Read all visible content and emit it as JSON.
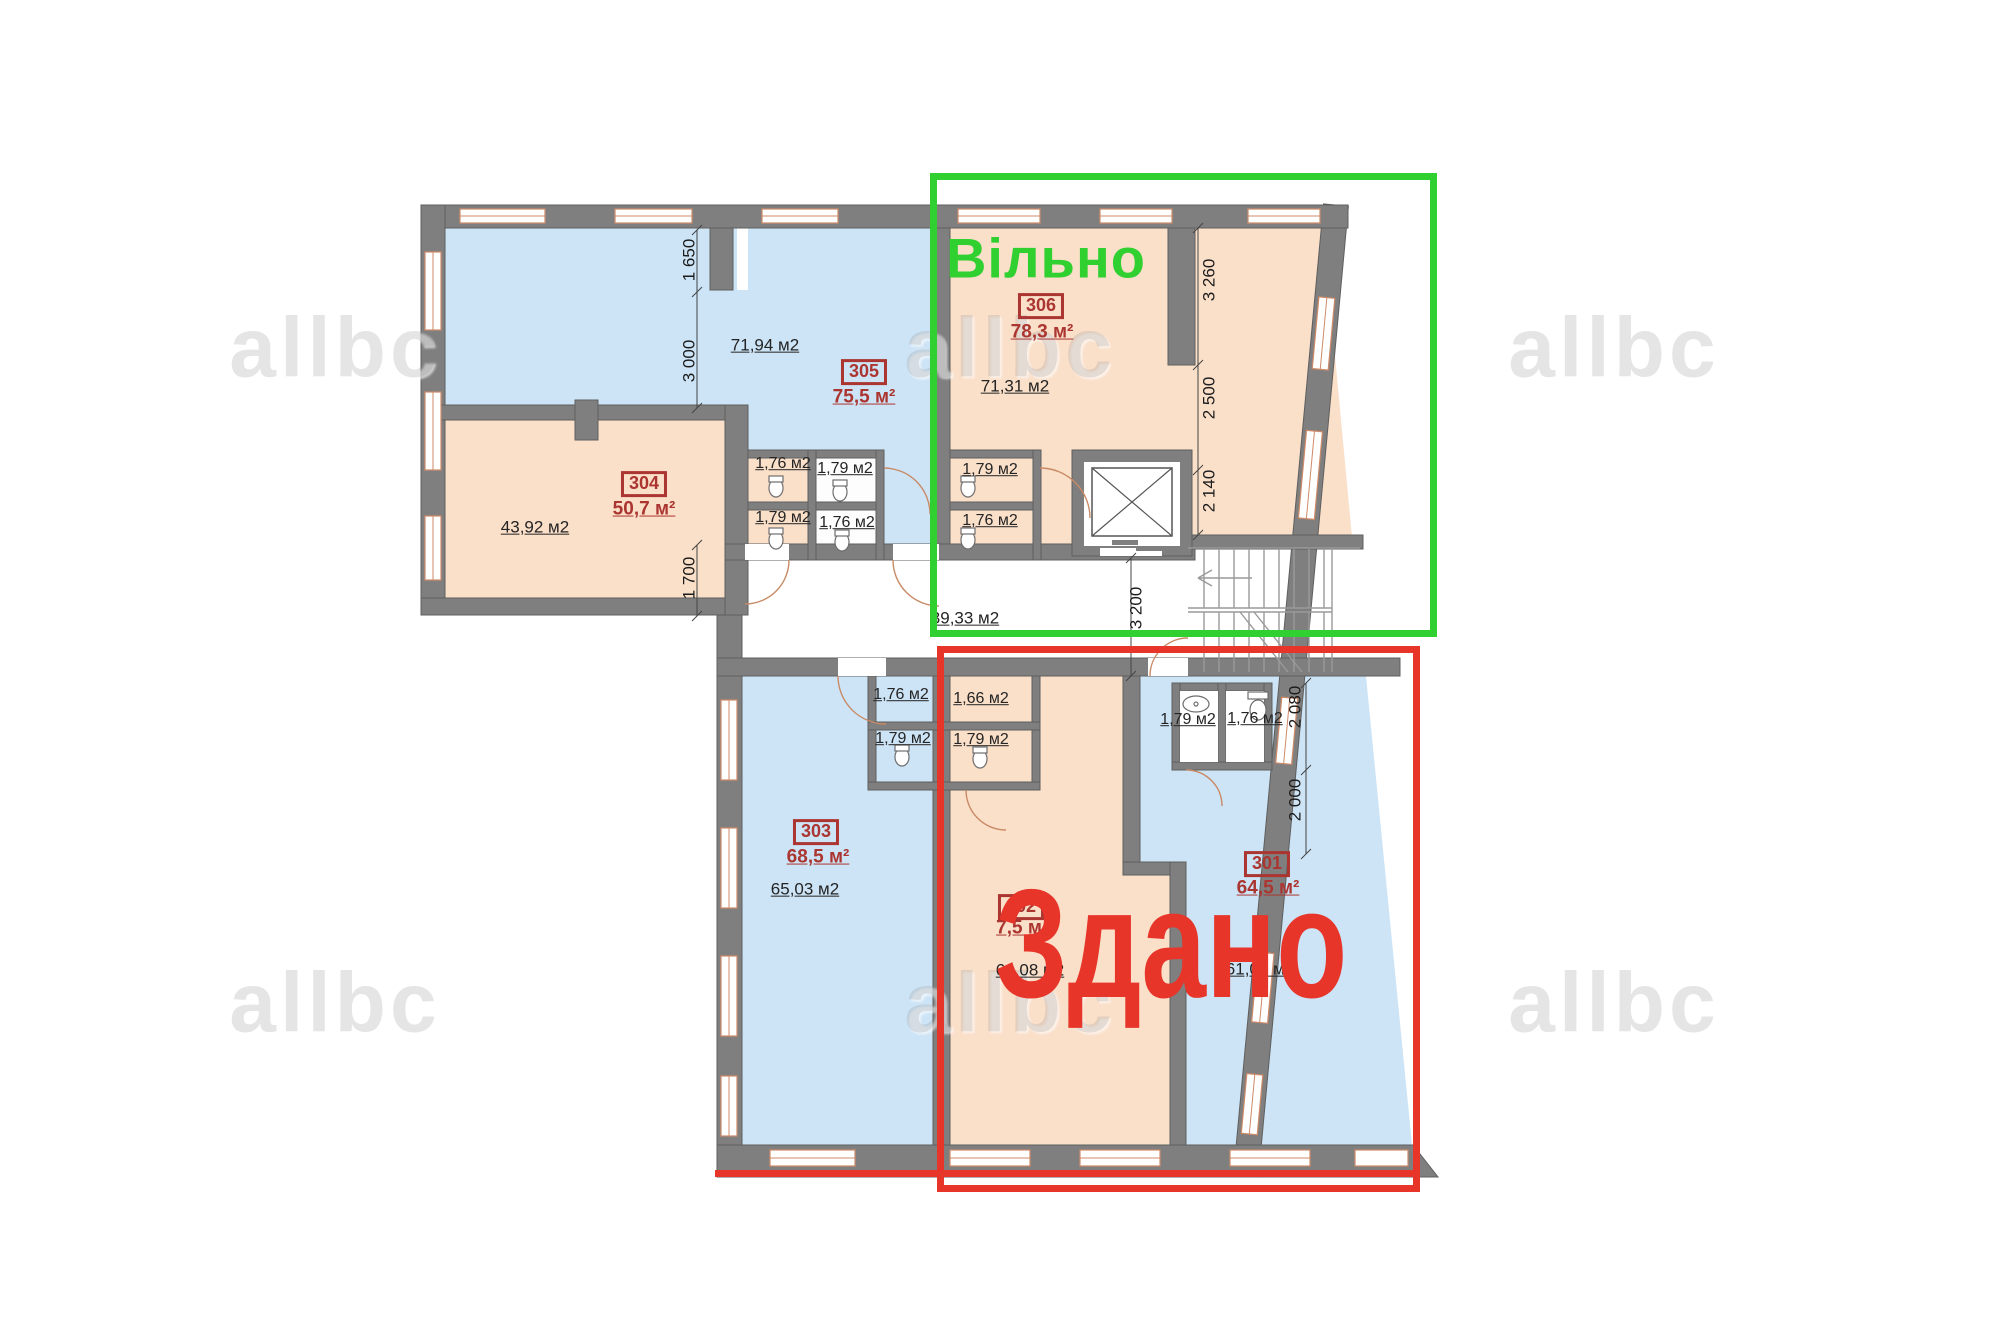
{
  "overlays": {
    "free_label": "Вільно",
    "free_color": "#2fd030",
    "rented_label": "Здано",
    "rented_color": "#e7352a"
  },
  "watermark": "allbc",
  "corridor_area": "39,33 м2",
  "rooms": [
    {
      "number": "301",
      "total_area": "64,5 м²",
      "room_area": "61,04 м2"
    },
    {
      "number": "302",
      "total_area": "7,5 м",
      "room_area": "64,08 м2"
    },
    {
      "number": "303",
      "total_area": "68,5 м²",
      "room_area": "65,03 м2"
    },
    {
      "number": "304",
      "total_area": "50,7 м²",
      "room_area": "43,92 м2"
    },
    {
      "number": "305",
      "total_area": "75,5 м²",
      "room_area": "71,94 м2"
    },
    {
      "number": "306",
      "total_area": "78,3 м²",
      "room_area": "71,31 м2"
    }
  ],
  "small_rooms": [
    "1,76 м2",
    "1,79 м2",
    "1,79 м2",
    "1,76 м2",
    "1,79 м2",
    "1,76 м2",
    "1,76 м2",
    "1,66 м2",
    "1,79 м2",
    "1,79 м2",
    "1,79 м2",
    "1,76 м2"
  ],
  "dimensions": [
    "1 650",
    "3 000",
    "1 700",
    "3 260",
    "2 500",
    "2 140",
    "3 200",
    "2 080",
    "2 000"
  ]
}
